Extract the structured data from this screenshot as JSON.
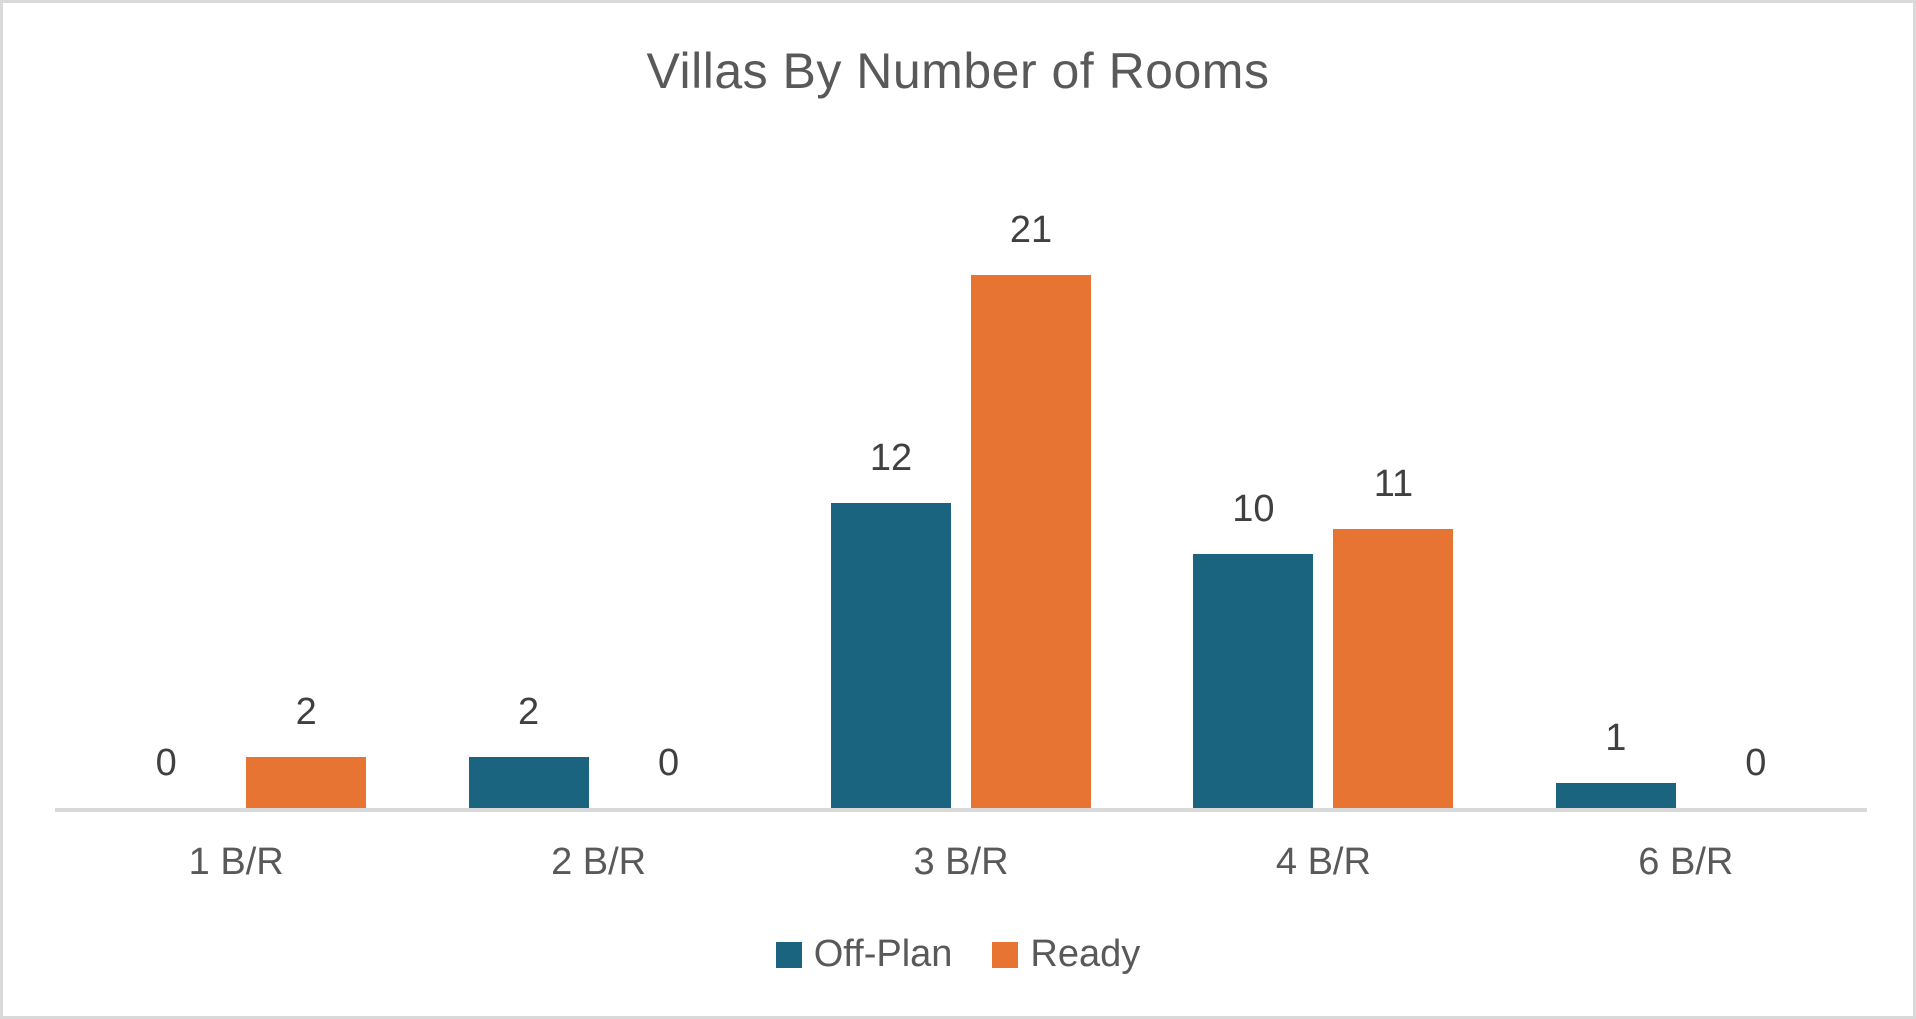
{
  "chart_data": {
    "type": "bar",
    "title": "Villas By Number of Rooms",
    "categories": [
      "1 B/R",
      "2 B/R",
      "3 B/R",
      "4 B/R",
      "6 B/R"
    ],
    "series": [
      {
        "name": "Off-Plan",
        "color": "#1A6480",
        "values": [
          0,
          2,
          12,
          10,
          1
        ]
      },
      {
        "name": "Ready",
        "color": "#E87434",
        "values": [
          2,
          0,
          21,
          11,
          0
        ]
      }
    ],
    "data_labels": true,
    "legend_position": "bottom",
    "y_axis_visible": false,
    "gridlines": false,
    "ylim": [
      0,
      25
    ]
  },
  "colors": {
    "title_text": "#595959",
    "data_label_text": "#404040",
    "axis_label_text": "#595959",
    "axis_line": "#D9D9D9",
    "frame_border": "#D9D9D9",
    "background": "#FFFFFF"
  }
}
